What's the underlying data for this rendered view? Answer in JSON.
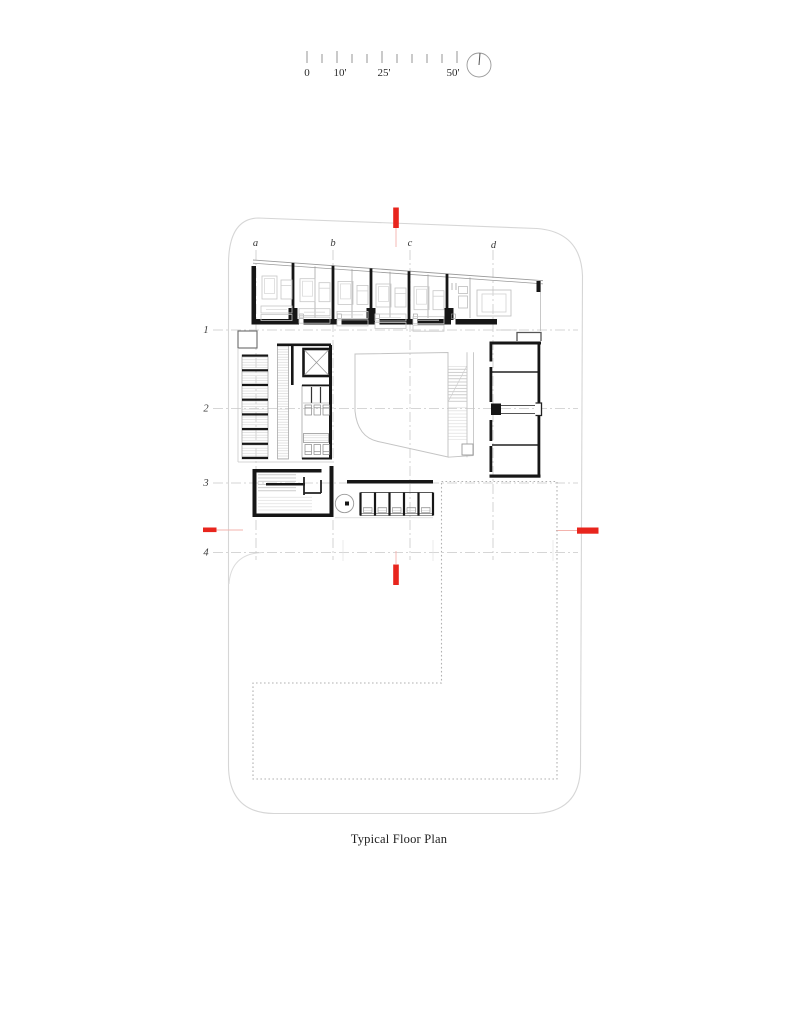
{
  "sheet": {
    "title": "Typical Floor Plan"
  },
  "scale_bar": {
    "labels": [
      "0",
      "10'",
      "25'",
      "50'"
    ]
  },
  "grid": {
    "columns": [
      "a",
      "b",
      "c",
      "d"
    ],
    "rows": [
      "1",
      "2",
      "3",
      "4"
    ]
  },
  "colors": {
    "section_marker_red": "#e8251d",
    "section_leader_red": "#f3b3ad",
    "wall_black": "#161616",
    "furniture_gray": "#c6c6c6",
    "boundary_gray": "#d6d6d6",
    "grid_gray": "#c6c6c6"
  },
  "icons": {
    "north_arrow": "north-arrow-circle"
  }
}
